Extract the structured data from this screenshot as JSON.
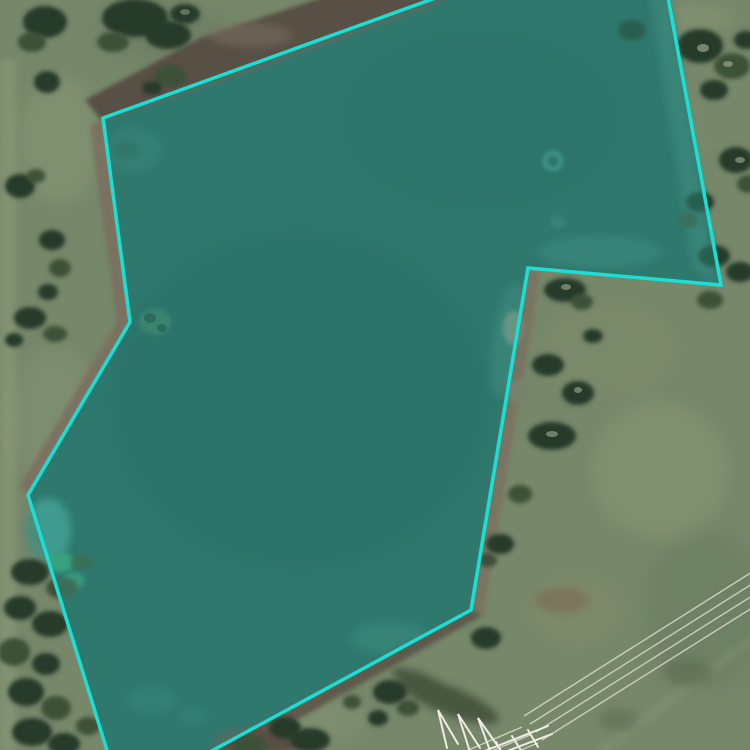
{
  "app": {
    "title": "aerial-parcel-viewer"
  },
  "map": {
    "view_type": "satellite-aerial",
    "overlay_polygon": {
      "label": "highlighted-water-parcel-boundary",
      "stroke_color": "#1bdfd4",
      "fill_color": "rgba(44,222,214,0.22)",
      "stroke_width": 3.5,
      "points": [
        [
          452,
          -8
        ],
        [
          667,
          -8
        ],
        [
          721,
          285
        ],
        [
          528,
          268
        ],
        [
          471,
          610
        ],
        [
          195,
          760
        ],
        [
          110,
          760
        ],
        [
          28,
          495
        ],
        [
          130,
          322
        ],
        [
          103,
          118
        ]
      ]
    },
    "palette": {
      "grass": "#76876a",
      "grass_light": "#95a17f",
      "grass_dark": "#5e7054",
      "grass_warm": "#8a8e6d",
      "water": "#2f5b51",
      "water_shallow": "#4a7a6a",
      "water_deep": "#24443c",
      "mud": "#585044",
      "bank": "#7b7060",
      "tree_dark": "#283b29",
      "tree_mid": "#3c5138",
      "tree_gray": "#77816d",
      "canopy_speck": "#bcc3b0",
      "bush_bright": "#3c8f68",
      "power_line": "#d9dac9",
      "tower": "#ededE4",
      "shadow": "#333d2c",
      "red_patch": "#7a6450"
    },
    "features": [
      "lake-water-body",
      "grass-field",
      "tree-clusters",
      "mud-bank-shore",
      "shallow-water-margins",
      "transmission-tower",
      "power-lines",
      "parcel-boundary-polygon"
    ]
  }
}
